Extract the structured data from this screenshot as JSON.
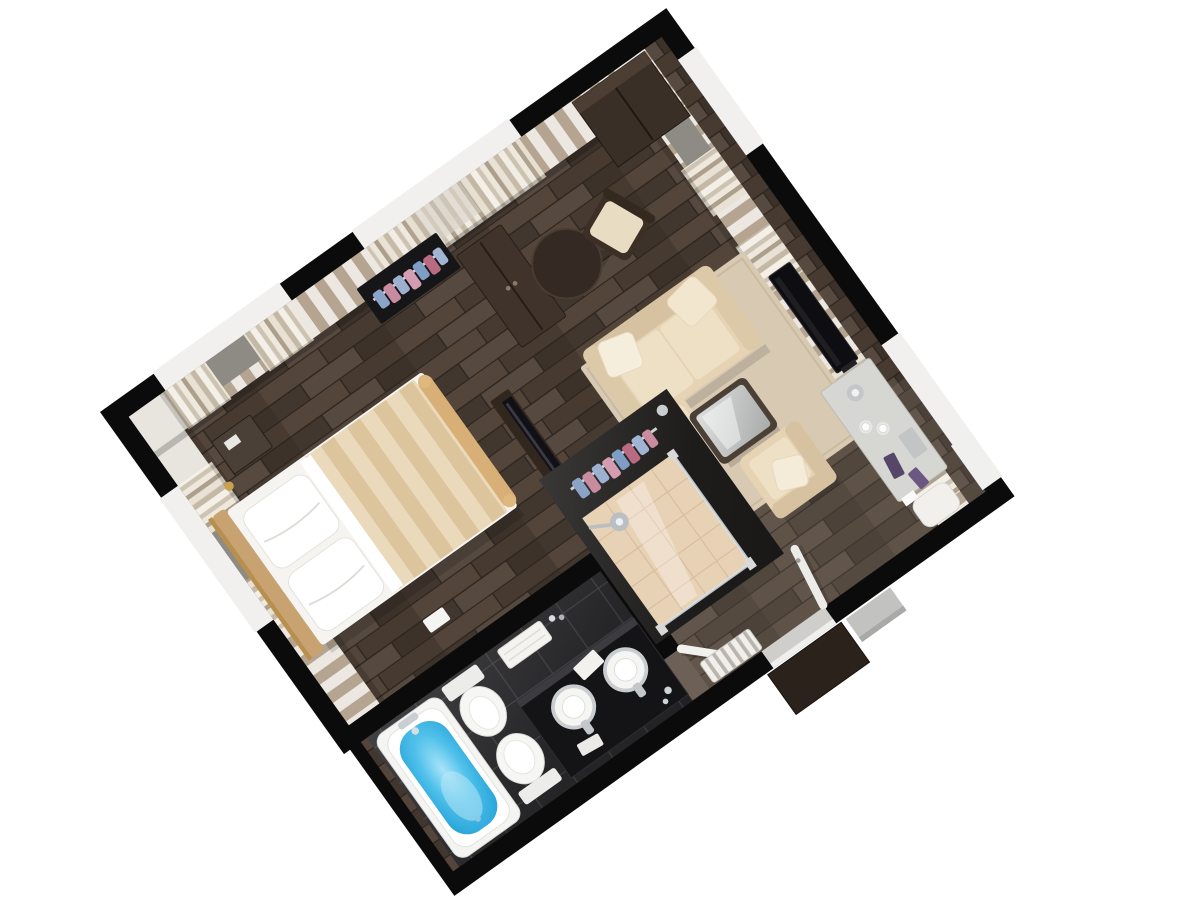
{
  "scene": {
    "title": "3D isometric floor plan render of a one-bedroom hotel suite",
    "view": "top-down axonometric, plan rotated about -35 degrees",
    "background": "#ffffff"
  },
  "palette": {
    "wall_black": "#0b0b0c",
    "wall_edge": "#2b2b2e",
    "wallpaper_beige": "#b4a490",
    "wallpaper_white": "#ece8e1",
    "plain_wall_white": "#e8e5df",
    "floor_wood": "#463a31",
    "floor_wood_light": "#53453a",
    "floor_wood_dark": "#3c322a",
    "corridor_tint": "#a39a8e",
    "bath_tile": "#222225",
    "tile_grout": "#3c3c40",
    "water_blue": "#4fc0ea",
    "water_light": "#a8e4f8",
    "tub_white": "#f4f4f2",
    "fixture_white": "#f5f5f3",
    "sofa_cream": "#e5d3b3",
    "sofa_back": "#d6c2a0",
    "cushion_cream": "#eee0c4",
    "pillow_cream": "#f6eedc",
    "rug_beige": "#d8c9b2",
    "blanket_light": "#ead9ba",
    "blanket_dark": "#dcc49d",
    "sheet_white": "#f6f4f0",
    "headboard_tan": "#c8a271",
    "gold": "#c9a24b",
    "wood_dark_furniture": "#3a2f27",
    "glass_gray": "#8e8b85",
    "curtain_cream": "#f5f0e7",
    "curtain_taupe": "#aca08c",
    "chrome": "#c9cdd0",
    "clothes_pink": "#c98ba0",
    "clothes_blue": "#8ba3c6",
    "desk_top": "#d6d6d3",
    "shower_tile": "#e8d2b6",
    "glass_edge": "#d6e2e6",
    "table_glass": "#c4c6c5"
  },
  "rooms": [
    {
      "id": "bedroom",
      "label": "Bedroom",
      "furniture": [
        "double bed with striped beige runner and white pillows",
        "tan headboard",
        "nightstand",
        "gold floor lamp",
        "open clothes rack with pink and blue garments",
        "dark wardrobe cabinet",
        "TV console with leaning TV"
      ]
    },
    {
      "id": "living-room",
      "label": "Living room",
      "furniture": [
        "cream three-seat sofa with pillows and chaise",
        "beige area rug",
        "dark coffee table with glass top",
        "cream armchair with pillow",
        "wall TV panel",
        "corner wardrobe",
        "round side table",
        "upholstered chair",
        "writing desk with lamp, coffee cups and accessories",
        "white stool"
      ]
    },
    {
      "id": "dressing-shower",
      "label": "Dressing area and shower",
      "furniture": [
        "open closet rack with hanging clothes",
        "walk-in shower with beige tile floor, glass panels and rain shower head"
      ]
    },
    {
      "id": "bathroom",
      "label": "Bathroom",
      "furniture": [
        "bathtub filled with blue water",
        "bidet",
        "toilet",
        "black vanity counter with two round vessel sinks and chrome faucets",
        "towels",
        "open white door"
      ]
    },
    {
      "id": "hallway",
      "label": "Hallway / entry",
      "furniture": [
        "entry door standing open",
        "doorway threshold with step",
        "louvered radiator panel"
      ]
    }
  ],
  "architecture": {
    "walls": "thick black perimeter walls with white window openings",
    "wallpaper": "vertical beige and white striped wallpaper on far wall faces",
    "windows": "gray glazing with cream and taupe curtains",
    "floors": [
      "dark wood planks in bedroom, living room and hallway",
      "glossy black tiles in bathroom",
      "beige tiles in shower"
    ]
  }
}
